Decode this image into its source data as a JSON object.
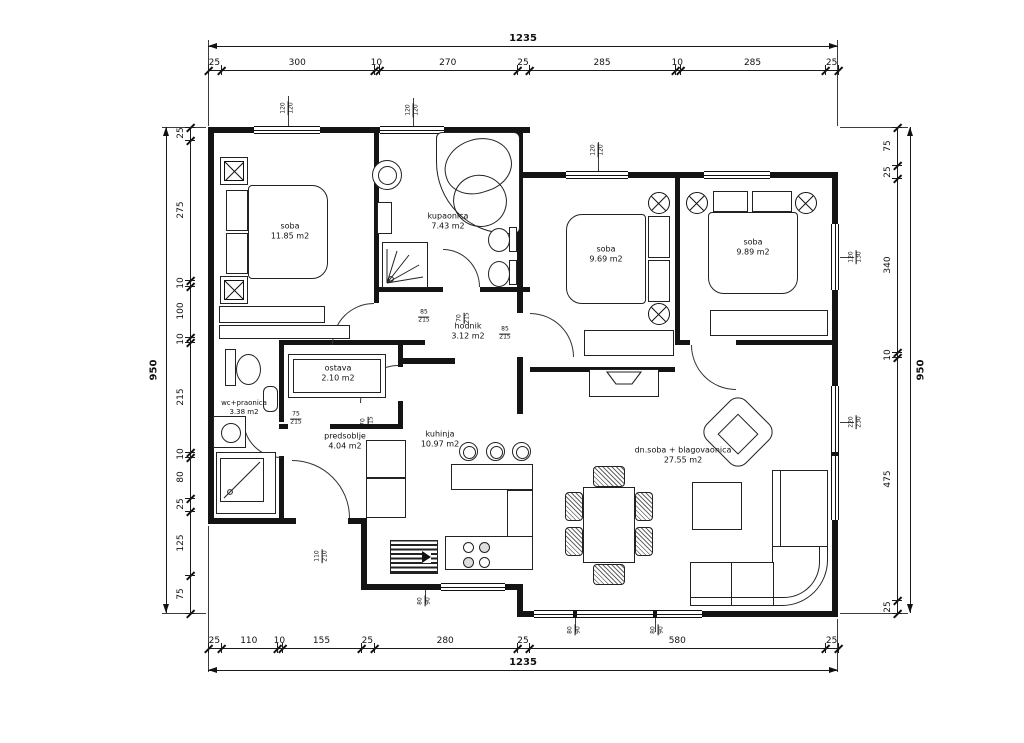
{
  "dims": {
    "top": {
      "total": "1235",
      "segments": [
        "25",
        "300",
        "10",
        "270",
        "25",
        "285",
        "10",
        "285",
        "25"
      ]
    },
    "bottom": {
      "total": "1235",
      "segments": [
        "25",
        "110",
        "10",
        "155",
        "25",
        "280",
        "25",
        "580",
        "25"
      ]
    },
    "left": {
      "total": "950",
      "segments": [
        "25",
        "275",
        "10",
        "100",
        "10",
        "215",
        "10",
        "80",
        "25",
        "125",
        "75"
      ]
    },
    "right": {
      "total": "950",
      "segments": [
        "75",
        "25",
        "340",
        "10",
        "475",
        "25"
      ]
    }
  },
  "rooms": [
    {
      "name": "soba",
      "area": "11.85 m2"
    },
    {
      "name": "kupaonica",
      "area": "7.43 m2"
    },
    {
      "name": "soba",
      "area": "9.69 m2"
    },
    {
      "name": "soba",
      "area": "9.89 m2"
    },
    {
      "name": "hodnik",
      "area": "3.12 m2"
    },
    {
      "name": "ostava",
      "area": "2.10 m2"
    },
    {
      "name": "wc+praonica",
      "area": "3.38 m2"
    },
    {
      "name": "predsoblje",
      "area": "4.04 m2"
    },
    {
      "name": "kuhinja",
      "area": "10.97 m2"
    },
    {
      "name": "dn.soba + blagovaonica",
      "area": "27.55 m2"
    }
  ],
  "openings": [
    {
      "w": "85",
      "h": "215"
    },
    {
      "w": "70",
      "h": "215"
    },
    {
      "w": "85",
      "h": "215"
    },
    {
      "w": "70",
      "h": "215"
    },
    {
      "w": "75",
      "h": "215"
    },
    {
      "w": "110",
      "h": "210"
    },
    {
      "w": "120",
      "h": "120"
    },
    {
      "w": "120",
      "h": "120"
    },
    {
      "w": "120",
      "h": "120"
    },
    {
      "w": "120",
      "h": "130"
    },
    {
      "w": "220",
      "h": "230"
    },
    {
      "w": "80",
      "h": "90"
    },
    {
      "w": "80",
      "h": "90"
    },
    {
      "w": "80",
      "h": "90"
    }
  ]
}
